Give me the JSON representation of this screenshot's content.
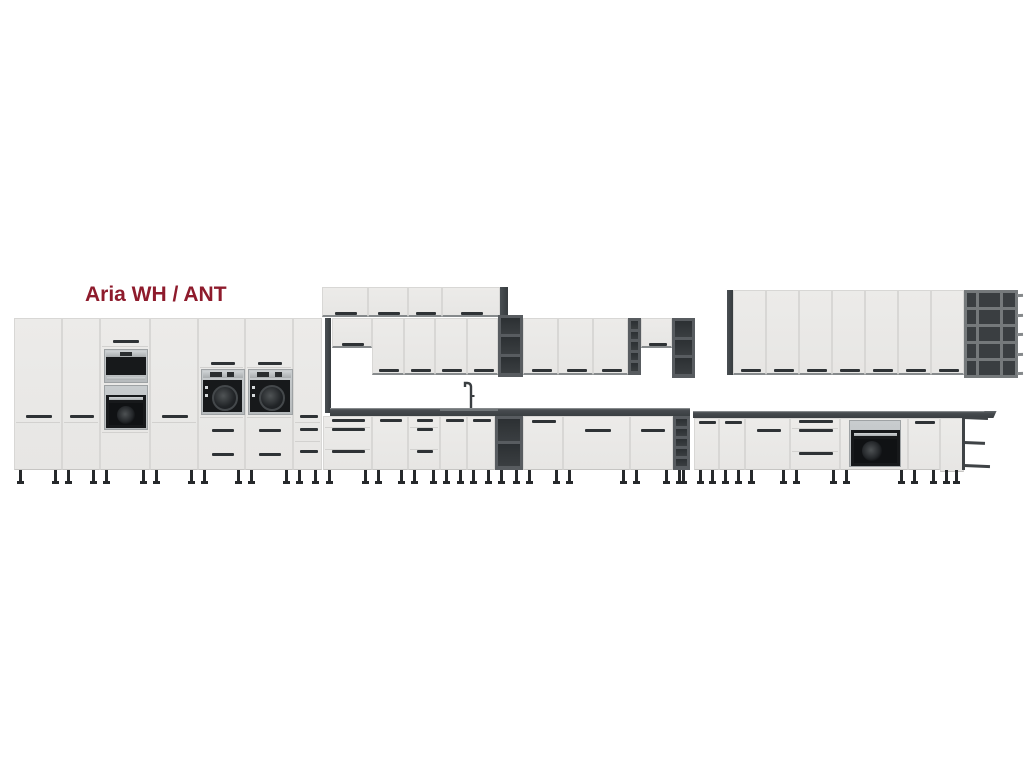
{
  "title": {
    "text": "Aria WH / ANT"
  },
  "palette": {
    "background": "#FFFFFF",
    "title_red": "#8E1B2C",
    "cabinet_front": "#ECEBE9",
    "door_seam": "#D8D7D5",
    "carcass_anthracite": "#43484C",
    "open_shelf_interior": "#2C3033",
    "countertop": "#3A3F42",
    "handle": "#2E3235",
    "appliance_black": "#17191B",
    "appliance_steel": "#B6BABC",
    "leg": "#26292B"
  },
  "scene": {
    "modules": [
      {
        "name": "tall-cabinet",
        "type": "door",
        "x": 14,
        "y": 318,
        "w": 48,
        "h": 152,
        "seams": [
          103
        ],
        "handles": [
          {
            "y": 96,
            "w": 26
          }
        ],
        "legs": true
      },
      {
        "name": "tall-cabinet",
        "type": "door",
        "x": 62,
        "y": 318,
        "w": 38,
        "h": 152,
        "seams": [
          103
        ],
        "handles": [
          {
            "y": 96,
            "w": 24
          }
        ],
        "legs": true
      },
      {
        "name": "tall-oven-housing",
        "type": "oven-tower",
        "x": 100,
        "y": 318,
        "w": 50,
        "h": 152,
        "legs": true
      },
      {
        "name": "tall-cabinet",
        "type": "door",
        "x": 150,
        "y": 318,
        "w": 48,
        "h": 152,
        "seams": [
          103
        ],
        "handles": [
          {
            "y": 96,
            "w": 26
          }
        ],
        "legs": true
      },
      {
        "name": "tall-compact-oven-housing",
        "type": "washer-tower",
        "x": 198,
        "y": 318,
        "w": 47,
        "h": 152,
        "legs": true
      },
      {
        "name": "tall-compact-oven-housing",
        "type": "washer-tower",
        "x": 245,
        "y": 318,
        "w": 48,
        "h": 152,
        "legs": true
      },
      {
        "name": "tall-cabinet-narrow",
        "type": "door",
        "x": 293,
        "y": 318,
        "w": 29,
        "h": 152,
        "seams": [
          103,
          122
        ],
        "handles": [
          {
            "y": 96,
            "w": 18
          },
          {
            "y": 109,
            "w": 18
          },
          {
            "y": 131,
            "w": 18
          }
        ],
        "legs": true
      },
      {
        "name": "top-box-cabinet",
        "type": "door",
        "x": 322,
        "y": 287,
        "w": 46,
        "h": 30,
        "handles": [
          {
            "y": 24,
            "w": 22
          }
        ],
        "bedge": true
      },
      {
        "name": "top-box-cabinet",
        "type": "door",
        "x": 368,
        "y": 287,
        "w": 40,
        "h": 30,
        "handles": [
          {
            "y": 24,
            "w": 22
          }
        ],
        "bedge": true
      },
      {
        "name": "top-box-cabinet",
        "type": "door",
        "x": 408,
        "y": 287,
        "w": 34,
        "h": 30,
        "handles": [
          {
            "y": 24,
            "w": 20
          }
        ],
        "bedge": true
      },
      {
        "name": "top-box-cabinet",
        "type": "door",
        "x": 442,
        "y": 287,
        "w": 58,
        "h": 30,
        "handles": [
          {
            "y": 24,
            "w": 22
          }
        ],
        "bedge": true
      },
      {
        "name": "carcass-side-panel",
        "type": "panel",
        "x": 500,
        "y": 287,
        "w": 8,
        "h": 31
      },
      {
        "name": "tall-side-panel",
        "type": "panel",
        "x": 325,
        "y": 318,
        "w": 6,
        "h": 95
      },
      {
        "name": "wall-flap-cabinet",
        "type": "door",
        "x": 332,
        "y": 318,
        "w": 40,
        "h": 30,
        "handles": [
          {
            "y": 24,
            "w": 22
          }
        ],
        "bedge": true
      },
      {
        "name": "wall-cabinet",
        "type": "door",
        "x": 372,
        "y": 318,
        "w": 32,
        "h": 57,
        "handles": [
          {
            "y": 50,
            "w": 20
          }
        ],
        "bedge": true
      },
      {
        "name": "wall-cabinet",
        "type": "door",
        "x": 404,
        "y": 318,
        "w": 31,
        "h": 57,
        "handles": [
          {
            "y": 50,
            "w": 20
          }
        ],
        "bedge": true
      },
      {
        "name": "wall-cabinet",
        "type": "door",
        "x": 435,
        "y": 318,
        "w": 32,
        "h": 57,
        "handles": [
          {
            "y": 50,
            "w": 20
          }
        ],
        "bedge": true
      },
      {
        "name": "wall-cabinet",
        "type": "door",
        "x": 467,
        "y": 318,
        "w": 31,
        "h": 57,
        "handles": [
          {
            "y": 50,
            "w": 20
          }
        ],
        "bedge": true
      },
      {
        "name": "wall-open-shelf",
        "type": "open-shelf",
        "x": 498,
        "y": 315,
        "w": 25,
        "h": 62,
        "rows": 3
      },
      {
        "name": "wall-cabinet",
        "type": "door",
        "x": 523,
        "y": 318,
        "w": 35,
        "h": 57,
        "handles": [
          {
            "y": 50,
            "w": 20
          }
        ],
        "bedge": true
      },
      {
        "name": "wall-cabinet",
        "type": "door",
        "x": 558,
        "y": 318,
        "w": 35,
        "h": 57,
        "handles": [
          {
            "y": 50,
            "w": 20
          }
        ],
        "bedge": true
      },
      {
        "name": "wall-cabinet",
        "type": "door",
        "x": 593,
        "y": 318,
        "w": 35,
        "h": 57,
        "handles": [
          {
            "y": 50,
            "w": 20
          }
        ],
        "bedge": true
      },
      {
        "name": "wall-open-shelf-narrow",
        "type": "open-shelf",
        "x": 628,
        "y": 318,
        "w": 13,
        "h": 57,
        "rows": 5
      },
      {
        "name": "wall-flap-cabinet",
        "type": "door",
        "x": 641,
        "y": 318,
        "w": 31,
        "h": 30,
        "handles": [
          {
            "y": 24,
            "w": 18
          }
        ],
        "bedge": true
      },
      {
        "name": "wall-open-shelf",
        "type": "open-shelf",
        "x": 672,
        "y": 318,
        "w": 23,
        "h": 60,
        "rows": 3
      },
      {
        "name": "carcass-side-panel",
        "type": "panel",
        "x": 727,
        "y": 290,
        "w": 6,
        "h": 85
      },
      {
        "name": "wall-cabinet-tall",
        "type": "door",
        "x": 733,
        "y": 290,
        "w": 33,
        "h": 85,
        "handles": [
          {
            "y": 78,
            "w": 20
          }
        ],
        "bedge": true
      },
      {
        "name": "wall-cabinet-tall",
        "type": "door",
        "x": 766,
        "y": 290,
        "w": 33,
        "h": 85,
        "handles": [
          {
            "y": 78,
            "w": 20
          }
        ],
        "bedge": true
      },
      {
        "name": "wall-cabinet-tall",
        "type": "door",
        "x": 799,
        "y": 290,
        "w": 33,
        "h": 85,
        "handles": [
          {
            "y": 78,
            "w": 20
          }
        ],
        "bedge": true
      },
      {
        "name": "wall-cabinet-tall",
        "type": "door",
        "x": 832,
        "y": 290,
        "w": 33,
        "h": 85,
        "handles": [
          {
            "y": 78,
            "w": 20
          }
        ],
        "bedge": true
      },
      {
        "name": "wall-cabinet-tall",
        "type": "door",
        "x": 865,
        "y": 290,
        "w": 33,
        "h": 85,
        "handles": [
          {
            "y": 78,
            "w": 20
          }
        ],
        "bedge": true
      },
      {
        "name": "wall-cabinet-tall",
        "type": "door",
        "x": 898,
        "y": 290,
        "w": 33,
        "h": 85,
        "handles": [
          {
            "y": 78,
            "w": 20
          }
        ],
        "bedge": true
      },
      {
        "name": "wall-cabinet-tall",
        "type": "door",
        "x": 931,
        "y": 290,
        "w": 33,
        "h": 85,
        "handles": [
          {
            "y": 78,
            "w": 20
          }
        ],
        "bedge": true
      },
      {
        "name": "wall-grid-shelf",
        "type": "grid-shelf",
        "x": 964,
        "y": 290,
        "w": 54,
        "h": 88,
        "rows": 5
      },
      {
        "name": "worktop",
        "type": "counter",
        "x": 330,
        "y": 408,
        "w": 360,
        "h": 8,
        "sink": {
          "x": 110,
          "w": 58
        }
      },
      {
        "name": "worktop",
        "type": "counter",
        "x": 693,
        "y": 411,
        "w": 295,
        "h": 7,
        "tip": true
      },
      {
        "name": "faucet",
        "type": "faucet",
        "x": 462,
        "y": 381,
        "w": 14,
        "h": 27
      },
      {
        "name": "base-drawer-unit",
        "type": "drawers",
        "x": 323,
        "y": 416,
        "w": 49,
        "h": 54,
        "handleYs": [
          2,
          11,
          33
        ],
        "legs": true
      },
      {
        "name": "base-cabinet",
        "type": "door",
        "x": 372,
        "y": 416,
        "w": 36,
        "h": 54,
        "handles": [
          {
            "y": 2,
            "w": 22
          }
        ],
        "legs": true
      },
      {
        "name": "base-drawer-unit",
        "type": "drawers",
        "x": 408,
        "y": 416,
        "w": 32,
        "h": 54,
        "handleYs": [
          2,
          11,
          33
        ],
        "legs": true
      },
      {
        "name": "base-sink-cabinet",
        "type": "door",
        "x": 440,
        "y": 416,
        "w": 27,
        "h": 54,
        "handles": [
          {
            "y": 2,
            "w": 18
          }
        ],
        "legs": true
      },
      {
        "name": "base-sink-cabinet",
        "type": "door",
        "x": 467,
        "y": 416,
        "w": 28,
        "h": 54,
        "handles": [
          {
            "y": 2,
            "w": 18
          }
        ],
        "legs": true
      },
      {
        "name": "base-open-shelf",
        "type": "open-shelf",
        "x": 495,
        "y": 416,
        "w": 28,
        "h": 54,
        "rows": 2,
        "legs": true
      },
      {
        "name": "base-cabinet",
        "type": "door",
        "x": 523,
        "y": 416,
        "w": 40,
        "h": 54,
        "handles": [
          {
            "y": 3,
            "w": 24
          }
        ],
        "legs": true
      },
      {
        "name": "base-cabinet-wide",
        "type": "door",
        "x": 563,
        "y": 416,
        "w": 67,
        "h": 54,
        "handles": [
          {
            "y": 12,
            "w": 26
          }
        ],
        "legs": true
      },
      {
        "name": "base-cabinet",
        "type": "door",
        "x": 630,
        "y": 416,
        "w": 43,
        "h": 54,
        "handles": [
          {
            "y": 12,
            "w": 24
          }
        ],
        "legs": true
      },
      {
        "name": "base-open-shelf-narrow",
        "type": "open-shelf",
        "x": 673,
        "y": 416,
        "w": 17,
        "h": 54,
        "rows": 5,
        "legs": true
      },
      {
        "name": "base-cabinet",
        "type": "door",
        "x": 694,
        "y": 418,
        "w": 25,
        "h": 52,
        "handles": [
          {
            "y": 2,
            "w": 17
          }
        ],
        "legs": true
      },
      {
        "name": "base-cabinet",
        "type": "door",
        "x": 719,
        "y": 418,
        "w": 26,
        "h": 52,
        "handles": [
          {
            "y": 2,
            "w": 17
          }
        ],
        "legs": true
      },
      {
        "name": "base-cabinet-wide",
        "type": "door",
        "x": 745,
        "y": 418,
        "w": 45,
        "h": 52,
        "handles": [
          {
            "y": 10,
            "w": 24
          }
        ],
        "legs": true
      },
      {
        "name": "base-drawer-unit",
        "type": "drawers",
        "x": 790,
        "y": 418,
        "w": 50,
        "h": 52,
        "handleYs": [
          1,
          10,
          33
        ],
        "legs": true
      },
      {
        "name": "base-oven-housing",
        "type": "oven-base",
        "x": 840,
        "y": 418,
        "w": 68,
        "h": 52,
        "legs": true
      },
      {
        "name": "base-cabinet",
        "type": "door",
        "x": 908,
        "y": 418,
        "w": 32,
        "h": 52,
        "handles": [
          {
            "y": 2,
            "w": 20
          }
        ],
        "legs": true
      },
      {
        "name": "base-end-shelf",
        "type": "end-shelf",
        "x": 940,
        "y": 414,
        "w": 50,
        "h": 56,
        "legXs": [
          3,
          13
        ]
      }
    ]
  }
}
